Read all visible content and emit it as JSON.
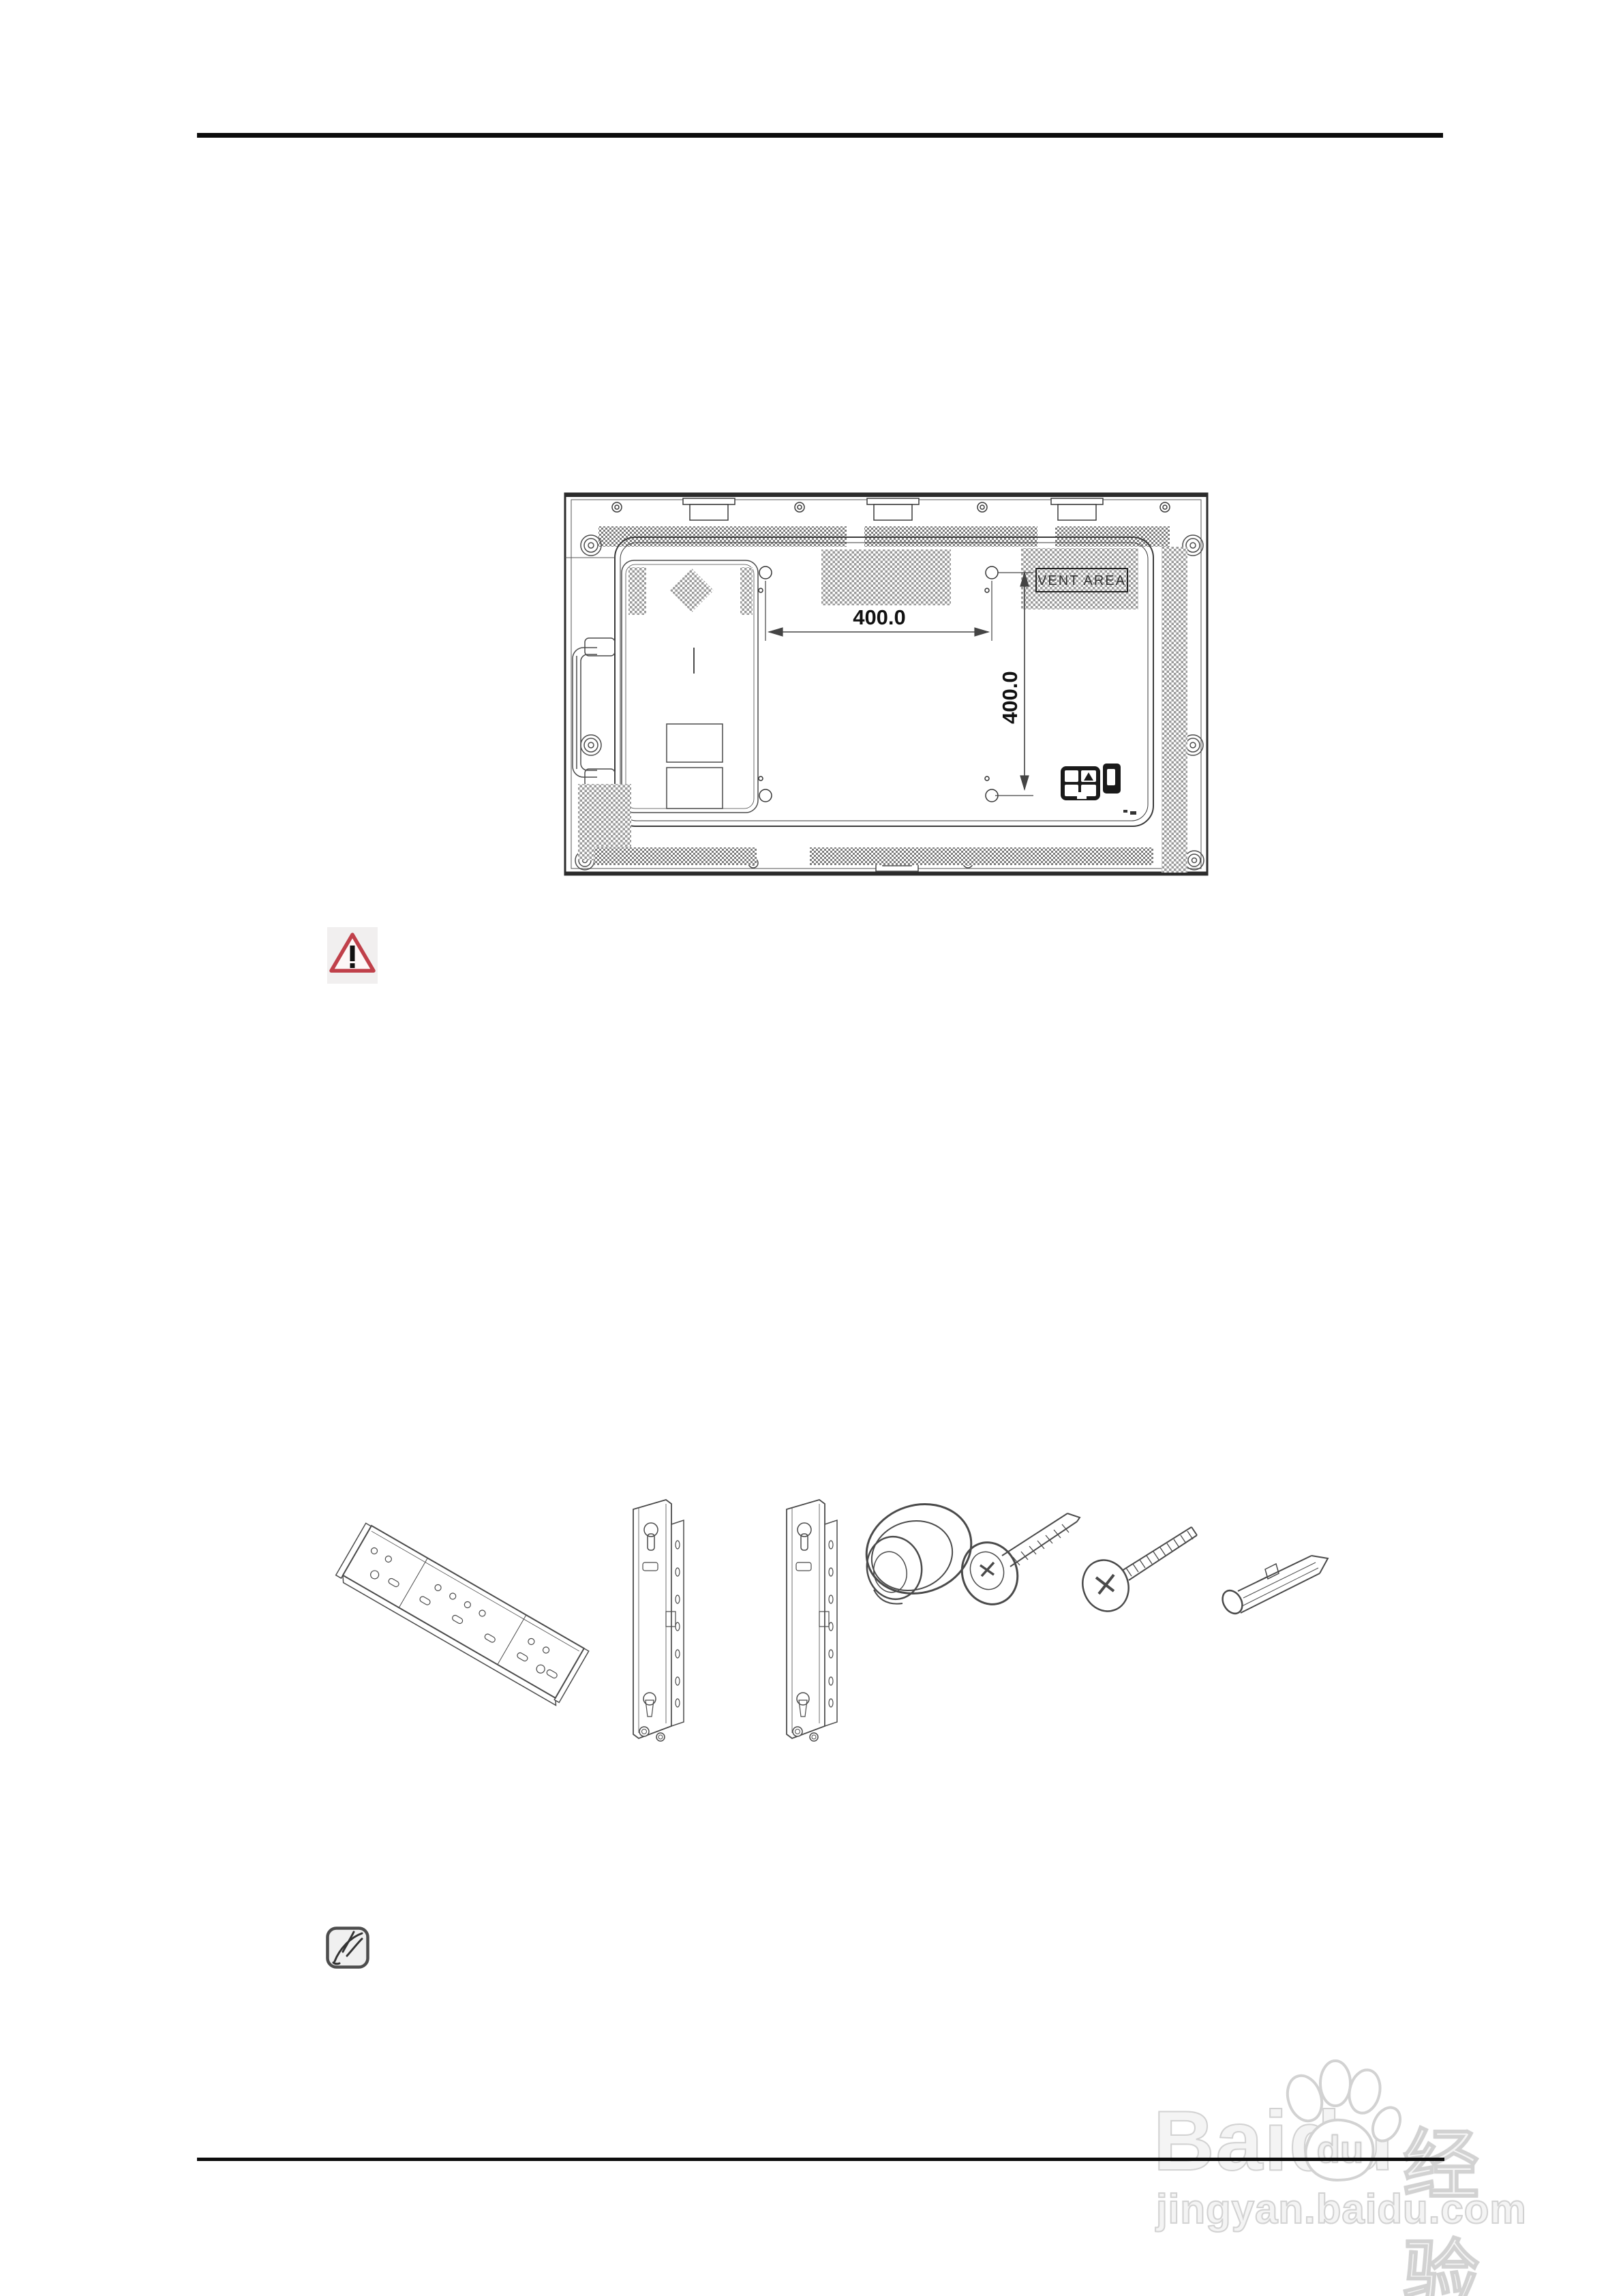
{
  "diagram": {
    "title": "display-rear-view-vesa-dimensions",
    "vent_area_label": "VENT AREA",
    "vesa_width": "400.0",
    "vesa_height": "400.0",
    "line_color": "#3a3a3a",
    "hatch_color": "#9a9a9a"
  },
  "warning_icon": {
    "triangle_color": "#c0404a",
    "background": "#f1efef",
    "mark": "!"
  },
  "note_icon": {
    "background": "#f0f0f0",
    "border_color": "#4d4d4d"
  },
  "hardware_parts": [
    {
      "name": "wall-mount-plate"
    },
    {
      "name": "vertical-bracket-left"
    },
    {
      "name": "vertical-bracket-right"
    },
    {
      "name": "holder-ring-spacer"
    },
    {
      "name": "tapping-screw"
    },
    {
      "name": "machine-screw"
    },
    {
      "name": "plastic-anchor"
    }
  ],
  "watermark": {
    "brand": "Baidu",
    "paw_text": "du",
    "suffix": "经验",
    "url": "jingyan.baidu.com",
    "color": "#ededed"
  }
}
